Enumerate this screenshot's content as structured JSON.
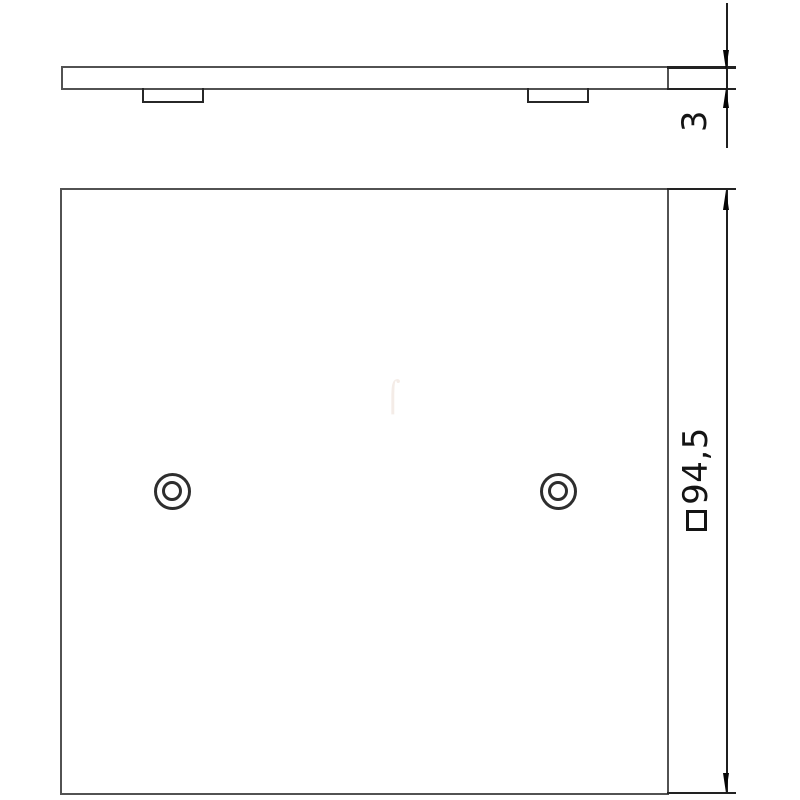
{
  "drawing": {
    "type": "technical-drawing",
    "background_color": "#ffffff",
    "outline_color": "#525252",
    "dimension_color": "#1f1f1f",
    "text_color": "#141414",
    "views": {
      "side_view": {
        "description": "side profile of cover plate with two snap-in tabs underneath"
      },
      "front_view": {
        "description": "square cover plate face with two concentric screw holes"
      }
    },
    "dimensions": {
      "thickness": {
        "value": "3"
      },
      "side_length": {
        "symbol": "□",
        "value": "94,5",
        "full_label": "□94,5"
      }
    }
  }
}
